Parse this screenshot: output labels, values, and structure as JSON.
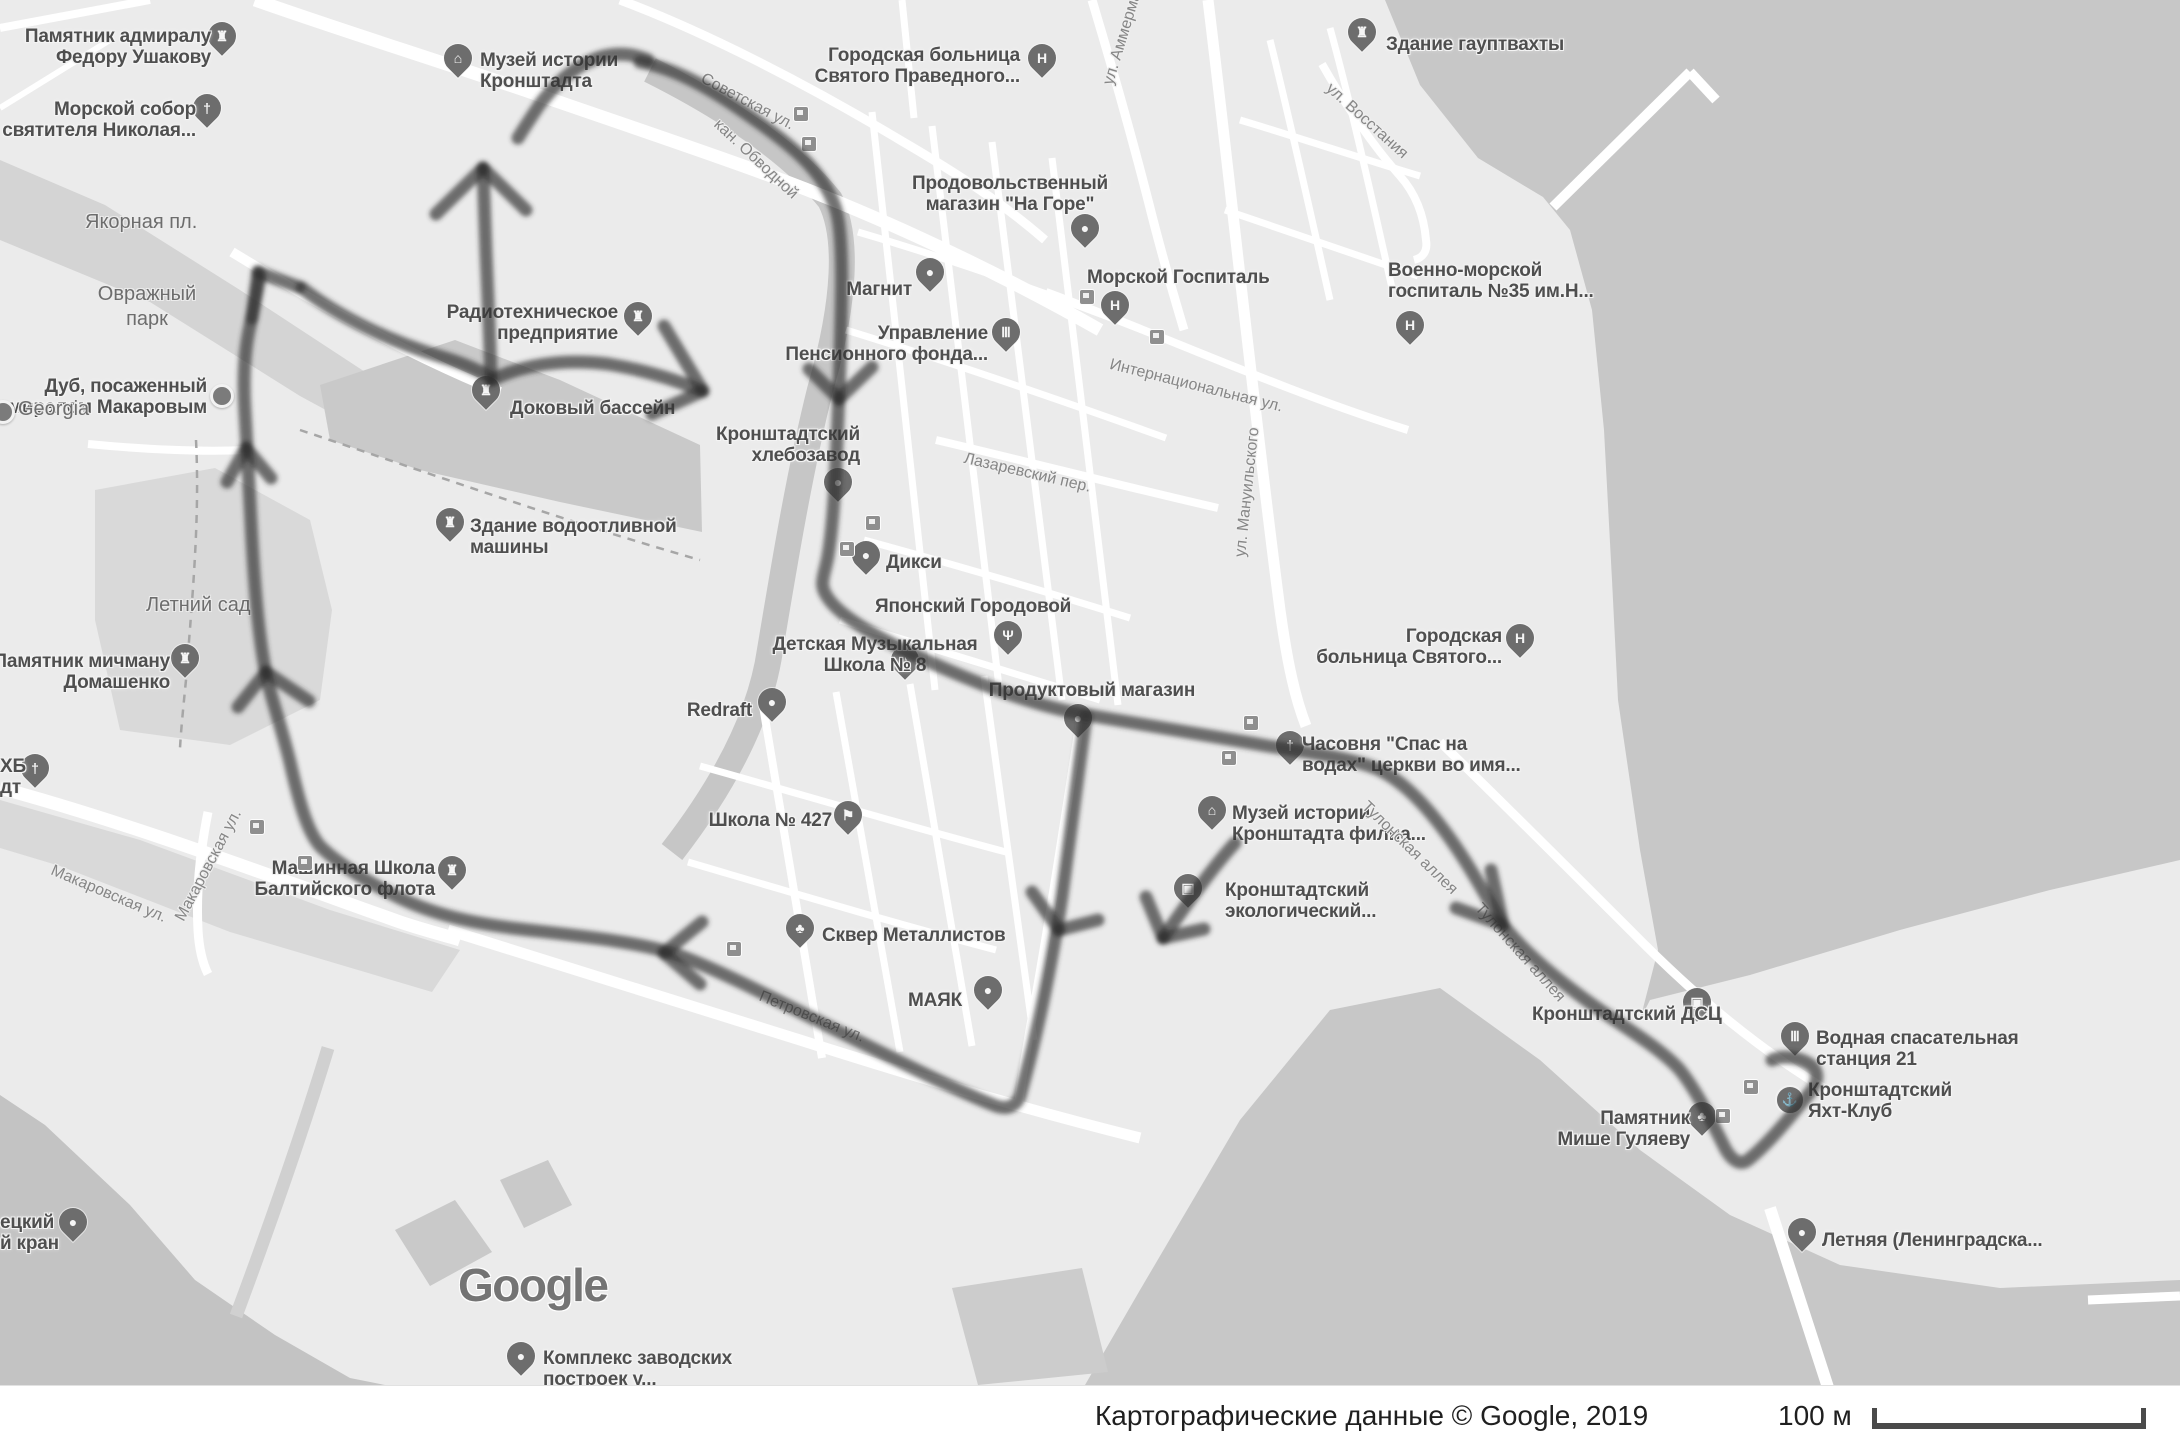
{
  "map": {
    "google_logo": "Google",
    "attribution": "Картографические данные © Google, 2019",
    "scale_label": "100 м",
    "colors": {
      "land": "#ebebeb",
      "water": "#c7c7c7",
      "park": "#d9d9d9",
      "dock_dark": "#c3c3c3",
      "road": "#ffffff",
      "route_ink": "#303030"
    },
    "pois": [
      {
        "id": "pamyatnik-ushakovu",
        "icon": "castle-icon",
        "char": "♜",
        "pin": "pin",
        "x": 222,
        "y": 46,
        "label": {
          "lines": [
            "Памятник адмиралу",
            "Федору Ушакову"
          ],
          "x": 211,
          "y": 26,
          "align": "right"
        }
      },
      {
        "id": "morskoy-sobor",
        "icon": "church-cross-icon",
        "char": "†",
        "pin": "pin",
        "x": 207,
        "y": 118,
        "label": {
          "lines": [
            "Морской собор",
            "святителя Николая..."
          ],
          "x": 196,
          "y": 99,
          "align": "right"
        }
      },
      {
        "id": "muzey-istorii-kronshtadta",
        "icon": "museum-icon",
        "char": "⌂",
        "pin": "pin",
        "x": 458,
        "y": 68,
        "label": {
          "lines": [
            "Музей истории",
            "Кронштадта"
          ],
          "x": 480,
          "y": 50,
          "align": "left"
        }
      },
      {
        "id": "gorodskaya-bolnitsa-pravednogo",
        "icon": "hospital-icon",
        "char": "H",
        "pin": "pin",
        "x": 1042,
        "y": 68,
        "label": {
          "lines": [
            "Городская больница",
            "Святого Праведного..."
          ],
          "x": 1020,
          "y": 45,
          "align": "right"
        }
      },
      {
        "id": "zdanie-gauptvahty",
        "icon": "castle-icon",
        "char": "♜",
        "pin": "pin",
        "x": 1362,
        "y": 42,
        "label": {
          "lines": [
            "Здание гауптвахты"
          ],
          "x": 1386,
          "y": 34,
          "align": "left"
        }
      },
      {
        "id": "prodovolstvenny-magazin",
        "icon": "cart-icon",
        "char": "●",
        "pin": "pin",
        "x": 1085,
        "y": 238,
        "label": {
          "lines": [
            "Продовольственный",
            "магазин \"На Горе\""
          ],
          "x": 1010,
          "y": 173,
          "align": "center"
        }
      },
      {
        "id": "magnit",
        "icon": "shopping-bag-icon",
        "char": "●",
        "pin": "pin",
        "x": 930,
        "y": 282,
        "label": {
          "lines": [
            "Магнит"
          ],
          "x": 912,
          "y": 279,
          "align": "right"
        }
      },
      {
        "id": "upravlenie-pensionnogo-fonda",
        "icon": "bank-columns-icon",
        "char": "Ⅲ",
        "pin": "pin",
        "x": 1006,
        "y": 342,
        "label": {
          "lines": [
            "Управление",
            "Пенсионного фонда..."
          ],
          "x": 988,
          "y": 323,
          "align": "right"
        }
      },
      {
        "id": "morskoy-gospital",
        "icon": "hospital-icon",
        "char": "H",
        "pin": "pin",
        "x": 1115,
        "y": 315,
        "label": {
          "lines": [
            "Морской Госпиталь"
          ],
          "x": 1087,
          "y": 267,
          "align": "left"
        }
      },
      {
        "id": "voenno-morskoy-gospital",
        "icon": "hospital-icon",
        "char": "H",
        "pin": "pin",
        "x": 1410,
        "y": 335,
        "label": {
          "lines": [
            "Военно-морской",
            "госпиталь №35 им.Н..."
          ],
          "x": 1388,
          "y": 260,
          "align": "left"
        }
      },
      {
        "id": "radiotehnicheskoe-predpriyatie",
        "icon": "castle-icon",
        "char": "♜",
        "pin": "pin",
        "x": 638,
        "y": 326,
        "label": {
          "lines": [
            "Радиотехническое",
            "предприятие"
          ],
          "x": 618,
          "y": 302,
          "align": "right"
        }
      },
      {
        "id": "dokovy-basseyn",
        "icon": "castle-icon",
        "char": "♜",
        "pin": "pin",
        "x": 486,
        "y": 400,
        "label": {
          "lines": [
            "Доковый бассейн"
          ],
          "x": 510,
          "y": 398,
          "align": "left"
        }
      },
      {
        "id": "dub-makarova",
        "icon": "dot-icon",
        "char": "",
        "pin": "dot-pin",
        "x": 222,
        "y": 396,
        "label": {
          "lines": [
            "Дуб, посаженный",
            "адмиралом Макаровым"
          ],
          "x": 207,
          "y": 376,
          "align": "right"
        }
      },
      {
        "id": "zdanie-vodootlivnoy-mashiny",
        "icon": "castle-icon",
        "char": "♜",
        "pin": "pin",
        "x": 450,
        "y": 532,
        "label": {
          "lines": [
            "Здание водоотливной",
            "машины"
          ],
          "x": 470,
          "y": 516,
          "align": "left"
        }
      },
      {
        "id": "kronshtadtsky-hlebozavod",
        "icon": "dot-icon",
        "char": "●",
        "pin": "pin",
        "x": 838,
        "y": 492,
        "label": {
          "lines": [
            "Кронштадтский",
            "хлебозавод"
          ],
          "x": 860,
          "y": 424,
          "align": "right"
        }
      },
      {
        "id": "diksi",
        "icon": "cart-icon",
        "char": "●",
        "pin": "pin",
        "x": 866,
        "y": 565,
        "label": {
          "lines": [
            "Дикси"
          ],
          "x": 886,
          "y": 552,
          "align": "left"
        }
      },
      {
        "id": "yaponsky-gorodovoy",
        "icon": "restaurant-icon",
        "char": "Ψ",
        "pin": "pin",
        "x": 1008,
        "y": 645,
        "label": {
          "lines": [
            "Японский Городовой"
          ],
          "x": 875,
          "y": 596,
          "align": "left"
        }
      },
      {
        "id": "detskaya-muz-shkola-8",
        "icon": "music-icon",
        "char": "♪",
        "pin": "pin",
        "x": 905,
        "y": 670,
        "label": {
          "lines": [
            "Детская Музыкальная",
            "Школа № 8"
          ],
          "x": 875,
          "y": 634,
          "align": "center"
        }
      },
      {
        "id": "produktovy-magazin",
        "icon": "cart-icon",
        "char": "●",
        "pin": "pin",
        "x": 1078,
        "y": 728,
        "label": {
          "lines": [
            "Продуктовый магазин"
          ],
          "x": 1092,
          "y": 680,
          "align": "center"
        }
      },
      {
        "id": "redraft",
        "icon": "shopping-bag-icon",
        "char": "●",
        "pin": "pin",
        "x": 772,
        "y": 712,
        "label": {
          "lines": [
            "Redraft"
          ],
          "x": 752,
          "y": 700,
          "align": "right"
        }
      },
      {
        "id": "shkola-427",
        "icon": "school-icon",
        "char": "⚑",
        "pin": "pin",
        "x": 848,
        "y": 825,
        "label": {
          "lines": [
            "Школа № 427"
          ],
          "x": 832,
          "y": 810,
          "align": "right"
        }
      },
      {
        "id": "skver-metallistov",
        "icon": "tree-icon",
        "char": "♣",
        "pin": "pin",
        "x": 800,
        "y": 938,
        "label": {
          "lines": [
            "Сквер Металлистов"
          ],
          "x": 822,
          "y": 925,
          "align": "left"
        }
      },
      {
        "id": "mayak",
        "icon": "dot-icon",
        "char": "●",
        "pin": "pin",
        "x": 988,
        "y": 1000,
        "label": {
          "lines": [
            "МАЯК"
          ],
          "x": 962,
          "y": 990,
          "align": "right"
        }
      },
      {
        "id": "mashinnaya-shkola",
        "icon": "castle-icon",
        "char": "♜",
        "pin": "pin",
        "x": 452,
        "y": 880,
        "label": {
          "lines": [
            "Машинная Школа",
            "Балтийского флота"
          ],
          "x": 435,
          "y": 858,
          "align": "right"
        }
      },
      {
        "id": "pamyatnik-domashenko",
        "icon": "castle-icon",
        "char": "♜",
        "pin": "pin",
        "x": 185,
        "y": 668,
        "label": {
          "lines": [
            "Памятник мичману",
            "Домашенко"
          ],
          "x": 170,
          "y": 651,
          "align": "right"
        }
      },
      {
        "id": "tserkov-ehb-fragment",
        "icon": "church-cross-icon",
        "char": "†",
        "pin": "pin",
        "x": 35,
        "y": 778,
        "label": {
          "lines": [
            "ХБ",
            "дт"
          ],
          "x": 0,
          "y": 756,
          "align": "left"
        }
      },
      {
        "id": "chasovnya-spas-na-vodah",
        "icon": "church-cross-icon",
        "char": "†",
        "pin": "pin",
        "x": 1290,
        "y": 755,
        "label": {
          "lines": [
            "Часовня \"Спас на",
            "водах\" церкви во имя..."
          ],
          "x": 1302,
          "y": 734,
          "align": "left"
        }
      },
      {
        "id": "muzey-istorii-filial",
        "icon": "museum-icon",
        "char": "⌂",
        "pin": "pin",
        "x": 1212,
        "y": 820,
        "label": {
          "lines": [
            "Музей истории",
            "Кронштадта филиа..."
          ],
          "x": 1232,
          "y": 803,
          "align": "left"
        }
      },
      {
        "id": "kronshtadtsky-ekologichesky",
        "icon": "camera-icon",
        "char": "▣",
        "pin": "pin",
        "x": 1188,
        "y": 898,
        "label": {
          "lines": [
            "Кронштадтский",
            "экологический..."
          ],
          "x": 1225,
          "y": 880,
          "align": "left"
        }
      },
      {
        "id": "gorodskaya-bolnitsa-svyatogo",
        "icon": "hospital-icon",
        "char": "H",
        "pin": "pin",
        "x": 1520,
        "y": 648,
        "label": {
          "lines": [
            "Городская",
            "больница Святого..."
          ],
          "x": 1502,
          "y": 626,
          "align": "right"
        }
      },
      {
        "id": "kronshtadtsky-dsc",
        "icon": "photo-pin-icon",
        "char": "▣",
        "pin": "pin",
        "x": 1697,
        "y": 1012,
        "label": {
          "lines": [
            "Кронштадтский ДСЦ"
          ],
          "x": 1532,
          "y": 1004,
          "align": "left"
        }
      },
      {
        "id": "vodnaya-spasatelnaya-stantsiya",
        "icon": "bank-columns-icon",
        "char": "Ⅲ",
        "pin": "pin",
        "x": 1795,
        "y": 1046,
        "label": {
          "lines": [
            "Водная спасательная",
            "станция 21"
          ],
          "x": 1816,
          "y": 1028,
          "align": "left"
        }
      },
      {
        "id": "yaht-klub",
        "icon": "anchor-icon",
        "char": "⚓",
        "pin": "circle-pin",
        "x": 1787,
        "y": 1097,
        "label": {
          "lines": [
            "Кронштадтский",
            "Яхт-Клуб"
          ],
          "x": 1808,
          "y": 1080,
          "align": "left"
        }
      },
      {
        "id": "pamyatnik-mishe-gulyaevu",
        "icon": "tree-icon",
        "char": "♣",
        "pin": "pin",
        "x": 1702,
        "y": 1126,
        "label": {
          "lines": [
            "Памятник",
            "Мише Гуляеву"
          ],
          "x": 1690,
          "y": 1108,
          "align": "right"
        }
      },
      {
        "id": "letnyaya-pristan",
        "icon": "boat-icon",
        "char": "●",
        "pin": "pin",
        "x": 1802,
        "y": 1242,
        "label": {
          "lines": [
            "Летняя (Ленинградска..."
          ],
          "x": 1822,
          "y": 1230,
          "align": "left"
        }
      },
      {
        "id": "kompleks-zavodskih",
        "icon": "dot-icon",
        "char": "●",
        "pin": "pin",
        "x": 521,
        "y": 1366,
        "label": {
          "lines": [
            "Комплекс заводских",
            "построек у..."
          ],
          "x": 543,
          "y": 1348,
          "align": "left"
        }
      },
      {
        "id": "kran-fragment",
        "icon": "dot-icon",
        "char": "●",
        "pin": "pin",
        "x": 73,
        "y": 1232,
        "label": {
          "lines": [
            "ецкий",
            "й кран"
          ],
          "x": 0,
          "y": 1212,
          "align": "left"
        }
      },
      {
        "id": "georgia",
        "icon": "dot-icon",
        "char": "",
        "pin": "dot-pin",
        "x": 3,
        "y": 412,
        "label": {
          "lines": [
            "Georgia"
          ],
          "x": 18,
          "y": 398,
          "align": "left",
          "kind": "area"
        }
      }
    ],
    "area_labels": [
      {
        "text": "Якорная пл.",
        "x": 85,
        "y": 211
      },
      {
        "text": "Овражный",
        "x": 107,
        "y": 283,
        "center": true
      },
      {
        "text": "парк",
        "x": 107,
        "y": 308,
        "center": true
      },
      {
        "text": "Летний сад",
        "x": 146,
        "y": 594
      }
    ],
    "street_labels": [
      {
        "text": "Советская ул.",
        "x": 706,
        "y": 70,
        "rot": 28
      },
      {
        "text": "кан. Обводной",
        "x": 722,
        "y": 116,
        "rot": 43
      },
      {
        "text": "ул. Аммермана",
        "x": 1100,
        "y": 82,
        "rot": -73
      },
      {
        "text": "ул. Восстания",
        "x": 1334,
        "y": 80,
        "rot": 42
      },
      {
        "text": "ул. Мануильского",
        "x": 1232,
        "y": 556,
        "rot": -84
      },
      {
        "text": "Интернациональная ул.",
        "x": 1112,
        "y": 356,
        "rot": 14
      },
      {
        "text": "Лазаревский пер.",
        "x": 966,
        "y": 450,
        "rot": 13
      },
      {
        "text": "Макаровская ул.",
        "x": 55,
        "y": 862,
        "rot": 23
      },
      {
        "text": "Макаровская ул.",
        "x": 172,
        "y": 916,
        "rot": -62
      },
      {
        "text": "Петровская ул.",
        "x": 763,
        "y": 988,
        "rot": 22
      },
      {
        "text": "Тулонская аллея",
        "x": 1370,
        "y": 798,
        "rot": 44
      },
      {
        "text": "Тулонская аллея",
        "x": 1484,
        "y": 900,
        "rot": 48
      }
    ],
    "bus_stops": [
      [
        800,
        113
      ],
      [
        808,
        143
      ],
      [
        1086,
        296
      ],
      [
        1156,
        336
      ],
      [
        872,
        522
      ],
      [
        846,
        548
      ],
      [
        733,
        948
      ],
      [
        256,
        826
      ],
      [
        304,
        862
      ],
      [
        1250,
        722
      ],
      [
        1228,
        757
      ],
      [
        1750,
        1086
      ],
      [
        1722,
        1115
      ]
    ],
    "route": {
      "strokes": [
        "M 648 60 C 610 44 572 62 540 104 C 532 116 524 128 518 138",
        "M 640 62 C 672 68 704 84 744 112 C 790 144 824 170 836 210 C 844 238 842 300 839 392 C 836 470 834 520 828 556 C 824 578 818 584 828 598 C 844 622 900 650 962 676 C 1010 696 1048 708 1082 714 C 1130 722 1200 734 1268 746 C 1318 754 1352 758 1380 770 C 1412 786 1444 826 1472 872 C 1484 892 1494 910 1503 925 C 1524 952 1560 982 1600 1010 C 1636 1034 1664 1052 1680 1070 C 1696 1090 1710 1118 1726 1150 C 1732 1160 1740 1166 1748 1160 C 1766 1146 1788 1120 1812 1090 C 1820 1078 1818 1068 1806 1062 C 1794 1056 1780 1056 1772 1060",
        "M 1086 716 C 1080 760 1072 820 1062 896 L 1057 928 C 1048 980 1036 1040 1020 1096 C 1016 1106 1008 1110 996 1106 C 960 1092 900 1062 840 1032 C 780 1002 724 972 678 955 C 640 942 580 936 520 929 C 470 923 430 914 392 894 C 360 878 334 860 320 846 C 308 832 300 806 290 762 C 280 722 270 694 266 674 C 258 634 254 580 251 522 C 249 480 247 448 245 412 C 243 380 244 352 250 326 C 254 306 258 288 260 276",
        "M 1235 843 C 1212 868 1186 905 1163 938",
        "M 302 288 C 340 318 392 342 442 357 C 462 363 478 370 490 377",
        "M 491 380 C 490 340 488 300 486 252 C 485 220 484 190 483 168",
        "M 492 380 C 520 366 560 358 608 364 C 644 370 676 380 700 390"
      ],
      "arrowheads": [
        "M 483 168 L 436 214",
        "M 483 168 L 526 210",
        "M 703 391 L 664 326",
        "M 703 391 L 652 414",
        "M 839 399 L 809 369",
        "M 839 399 L 872 367",
        "M 1059 930 L 1032 892",
        "M 1059 930 L 1098 920",
        "M 1163 938 L 1146 897",
        "M 1163 938 L 1204 929",
        "M 1503 925 L 1456 908",
        "M 1503 925 L 1491 870",
        "M 664 953 L 702 922",
        "M 664 953 L 700 984",
        "M 266 672 L 238 707",
        "M 266 672 L 309 701",
        "M 246 448 L 227 482",
        "M 246 448 L 271 478",
        "M 258 272 L 252 318",
        "M 258 272 L 299 287"
      ]
    }
  }
}
